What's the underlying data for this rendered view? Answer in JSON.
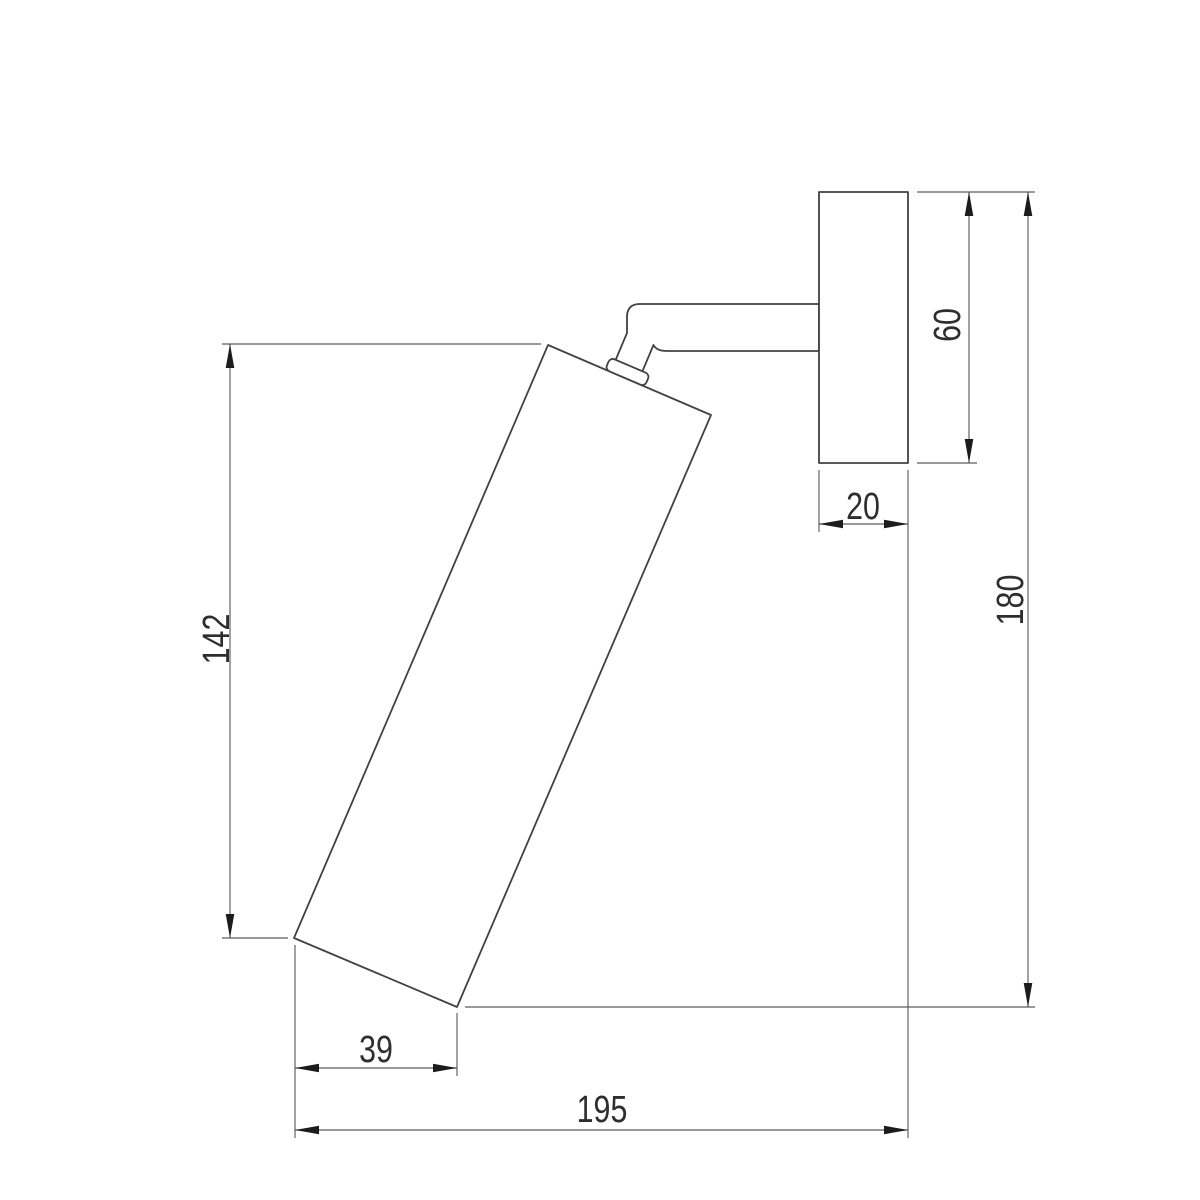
{
  "drawing": {
    "dimensions": {
      "lamp_length": "142",
      "plate_height": "60",
      "plate_depth": "20",
      "overall_height": "180",
      "base_offset": "39",
      "overall_projection": "195"
    }
  },
  "colors": {
    "background": "#ffffff",
    "part_outline": "#424242",
    "dimension_line": "#5c5c5c",
    "arrowhead": "#1c1c1c",
    "label_text": "#2e2e2e"
  }
}
